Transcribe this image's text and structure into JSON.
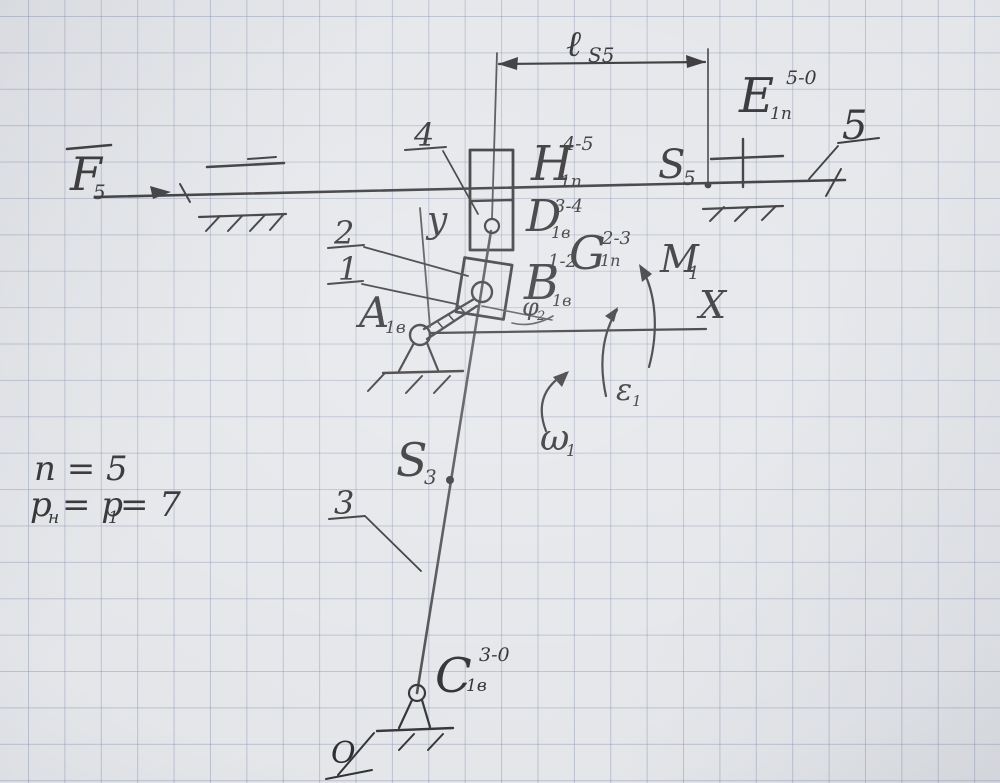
{
  "diagram": {
    "type": "hand-drawn kinematic scheme of a slotted-link mechanism on graph paper",
    "given": {
      "line1": "n = 5",
      "line2": {
        "p_main": "p",
        "p_sub": "н",
        "mid": "= p",
        "mid_sub": "1",
        "end": "= 7"
      }
    },
    "force": {
      "main": "F",
      "sub": "5"
    },
    "dimension": {
      "main": "ℓ",
      "sub": "S5"
    },
    "pairs": {
      "A": {
        "main": "A",
        "sub": "1в",
        "sup": ""
      },
      "B": {
        "main": "B",
        "sub": "1в",
        "sup": "1-2"
      },
      "G": {
        "main": "G",
        "sub": "1п",
        "sup": "2-3"
      },
      "D": {
        "main": "D",
        "sub": "1в",
        "sup": "3-4"
      },
      "H": {
        "main": "H",
        "sub": "1п",
        "sup": "4-5"
      },
      "E": {
        "main": "E",
        "sub": "1п",
        "sup": "5-0"
      },
      "C": {
        "main": "C",
        "sub": "1в",
        "sup": "3-0"
      }
    },
    "points": {
      "S5": {
        "main": "S",
        "sub": "5"
      },
      "S3": {
        "main": "S",
        "sub": "3"
      },
      "O": "O"
    },
    "axes": {
      "x": "X",
      "y": "y"
    },
    "motion": {
      "M1": {
        "main": "M",
        "sub": "1"
      },
      "omega1": {
        "main": "ω",
        "sub": "1"
      },
      "epsilon1": {
        "main": "ε",
        "sub": "1"
      },
      "phi2": {
        "main": "φ",
        "sub": "2"
      }
    },
    "links": {
      "l1": "1",
      "l2": "2",
      "l3": "3",
      "l4": "4",
      "l5": "5"
    }
  },
  "colors": {
    "paper": "#e4e6ea",
    "grid": "#b6bdca",
    "ink": "#333336",
    "pencil": "#4e4e52"
  }
}
